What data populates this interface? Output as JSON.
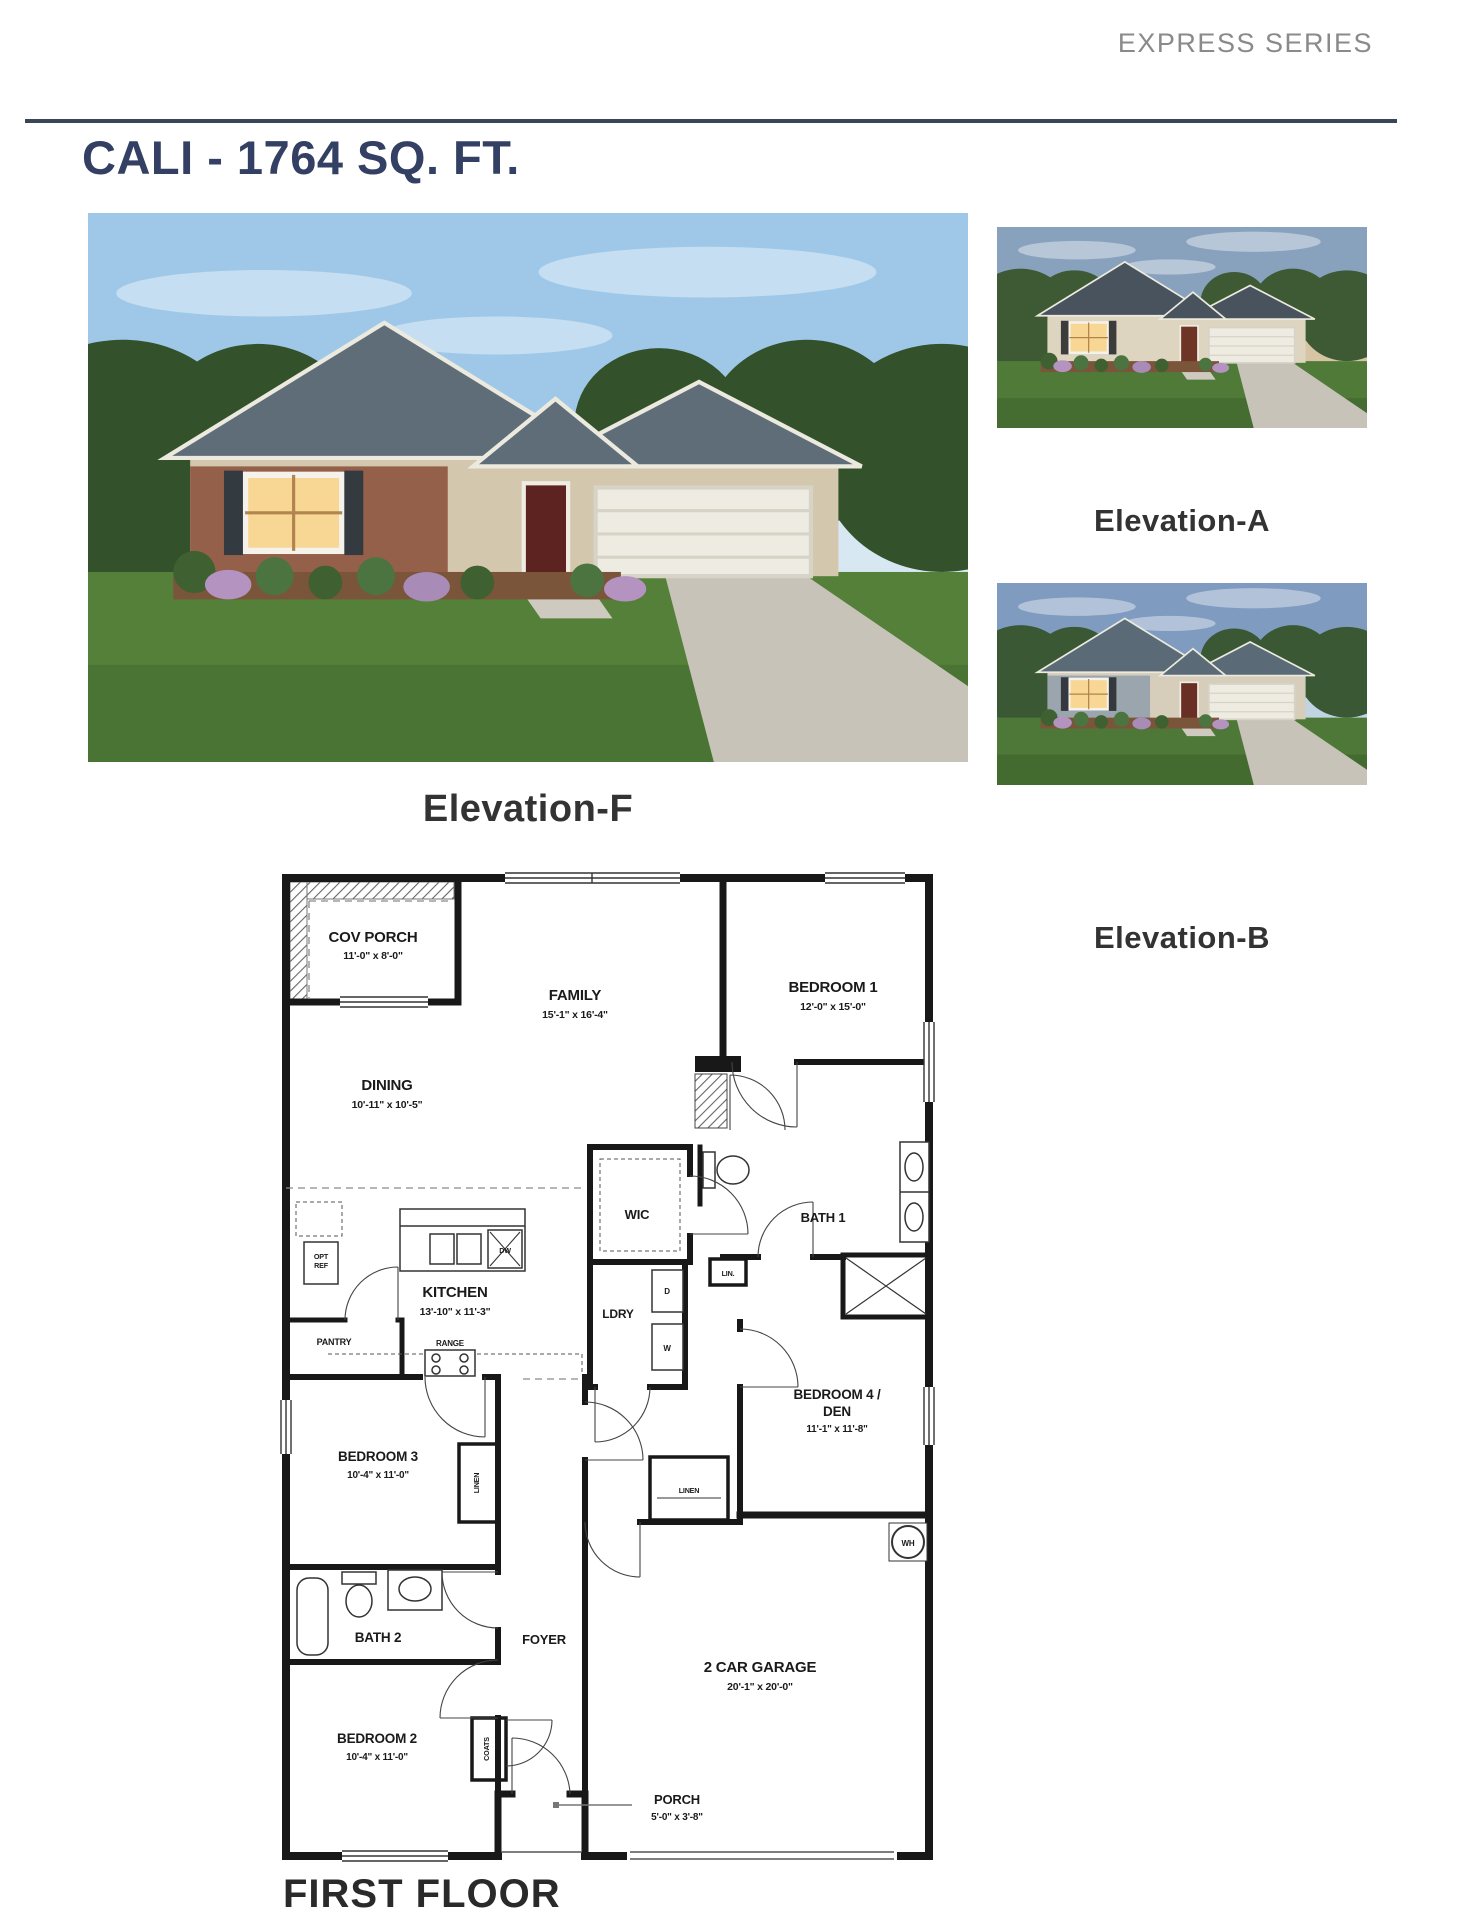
{
  "page": {
    "series_label": "EXPRESS SERIES",
    "title": "CALI - 1764 SQ. FT.",
    "first_floor_label": "FIRST FLOOR"
  },
  "colors": {
    "title_navy": "#333f63",
    "series_gray": "#8a8a8a",
    "rule": "#3b4559",
    "elevation_label": "#333333",
    "plan_ink": "#1a1a1a"
  },
  "elevations": {
    "f": {
      "label": "Elevation-F"
    },
    "a": {
      "label": "Elevation-A"
    },
    "b": {
      "label": "Elevation-B"
    }
  },
  "plan": {
    "cov_porch": {
      "name": "COV PORCH",
      "dims": "11'-0\" x 8'-0\""
    },
    "family": {
      "name": "FAMILY",
      "dims": "15'-1\" x 16'-4\""
    },
    "dining": {
      "name": "DINING",
      "dims": "10'-11\" x 10'-5\""
    },
    "bedroom1": {
      "name": "BEDROOM 1",
      "dims": "12'-0\" x 15'-0\""
    },
    "wic": {
      "name": "WIC"
    },
    "bath1": {
      "name": "BATH 1"
    },
    "lin": {
      "name": "LIN."
    },
    "kitchen": {
      "name": "KITCHEN",
      "dims": "13'-10\" x 11'-3\""
    },
    "pantry": {
      "name": "PANTRY"
    },
    "range": {
      "name": "RANGE"
    },
    "opt_ref": {
      "line1": "OPT",
      "line2": "REF"
    },
    "ldry": {
      "name": "LDRY"
    },
    "dryer": {
      "abbr": "D"
    },
    "washer": {
      "abbr": "W"
    },
    "dishwasher": {
      "abbr": "DW"
    },
    "water_heater": {
      "abbr": "WH"
    },
    "bedroom4": {
      "name_line1": "BEDROOM 4 /",
      "name_line2": "DEN",
      "dims": "11'-1\" x 11'-8\""
    },
    "linen_hall": {
      "name": "LINEN"
    },
    "linen_bedroom3": {
      "name": "LINEN"
    },
    "bedroom3": {
      "name": "BEDROOM 3",
      "dims": "10'-4\" x 11'-0\""
    },
    "bath2": {
      "name": "BATH 2"
    },
    "bedroom2": {
      "name": "BEDROOM 2",
      "dims": "10'-4\" x 11'-0\""
    },
    "foyer": {
      "name": "FOYER"
    },
    "coats": {
      "name": "COATS"
    },
    "garage": {
      "name": "2 CAR GARAGE",
      "dims": "20'-1\" x 20'-0\""
    },
    "porch": {
      "name": "PORCH",
      "dims": "5'-0\" x 3'-8\""
    }
  }
}
